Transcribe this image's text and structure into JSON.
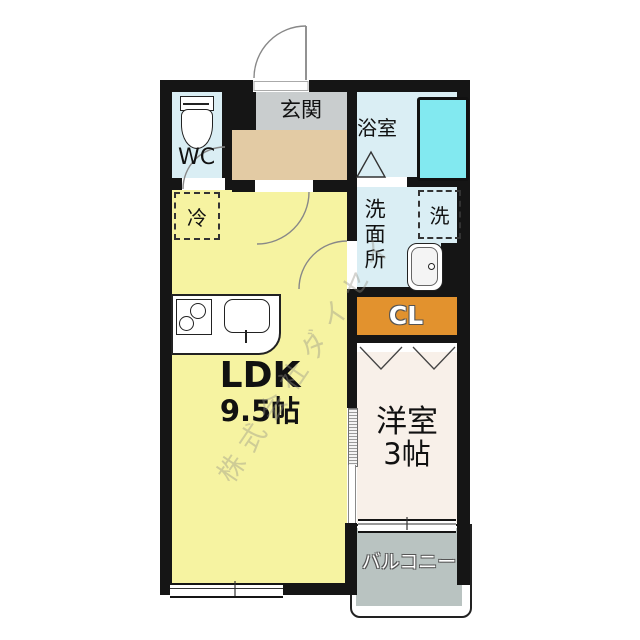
{
  "watermark": {
    "text": "株式会社ダイセイ"
  },
  "rooms": {
    "wc": {
      "label": "WC"
    },
    "entrance": {
      "label": "玄関"
    },
    "bath": {
      "label": "浴室"
    },
    "washroom": {
      "label": "洗面所"
    },
    "laundry": {
      "label": "洗"
    },
    "fridge": {
      "label": "冷"
    },
    "closet": {
      "label": "CL"
    },
    "ldk": {
      "label": "LDK",
      "size": "9.5帖"
    },
    "western": {
      "label": "洋室",
      "size": "3帖"
    },
    "balcony": {
      "label": "バルコニー"
    }
  },
  "colors": {
    "wall": "#151515",
    "ldk_floor": "#f6f3a1",
    "wet_area_floor": "#daeef4",
    "bathtub": "#82e9f0",
    "closet": "#e2922e",
    "entrance_landing": "#c9cdce",
    "entrance_hall": "#e3cba4",
    "western_floor": "#f8f0e9",
    "balcony_floor": "#b9c3c1"
  }
}
